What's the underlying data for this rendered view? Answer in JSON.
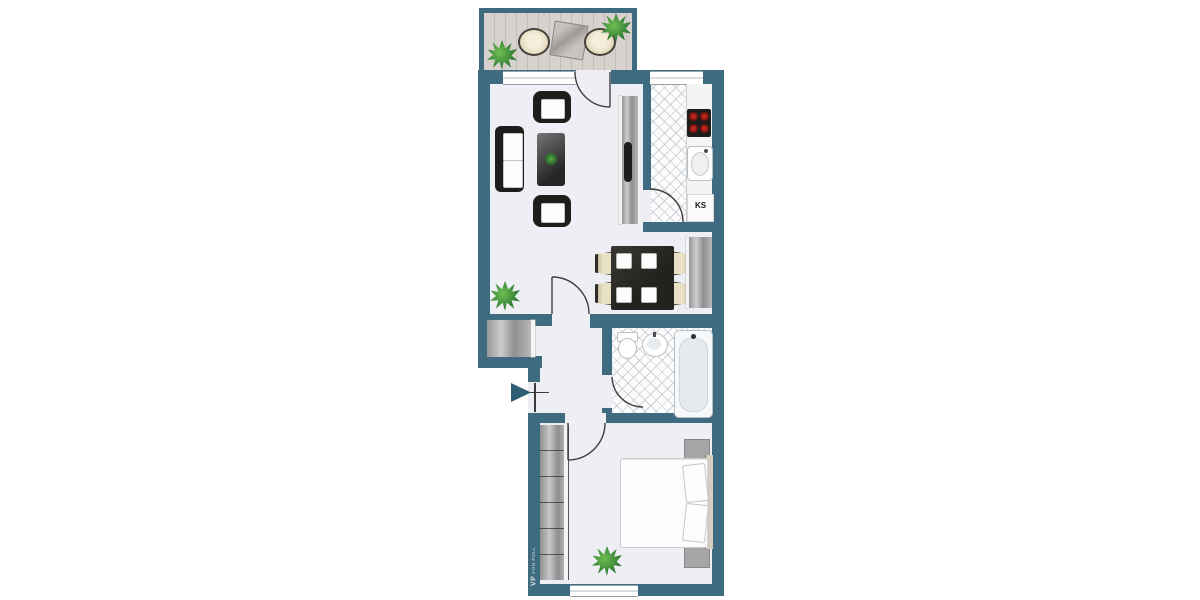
{
  "plan": {
    "type": "apartment-floor-plan",
    "areas": [
      "balcony",
      "living-room",
      "kitchen",
      "dining-area",
      "hallway",
      "bathroom",
      "bedroom"
    ]
  },
  "labels": {
    "refrigerator": "KS",
    "watermark_vp": "VP",
    "watermark_name": "VON POLL"
  },
  "icons": {
    "entrance": "arrow-right",
    "doors": "quarter-arc-swing",
    "plants": "foliage-star",
    "stove": "four-burner-cooktop"
  },
  "colors": {
    "wall": "#3e6b80",
    "floor": "#edeff4",
    "deck": "#d8d2cf",
    "deck_line": "#c4bcb8",
    "tile_base": "#fcfcfd",
    "tile_line": "#c3cad1",
    "counter": "#f4f4f5",
    "dark_furniture": "#1d1d1b",
    "chair_cream": "#e9e1c6",
    "burner_red": "#b3261e",
    "unit_gray": "#a5a5a5",
    "plant_green": "#2f7c33",
    "door_line": "#3f3f3f",
    "window_frame": "#96a0a8",
    "arrow": "#2f5d73"
  }
}
